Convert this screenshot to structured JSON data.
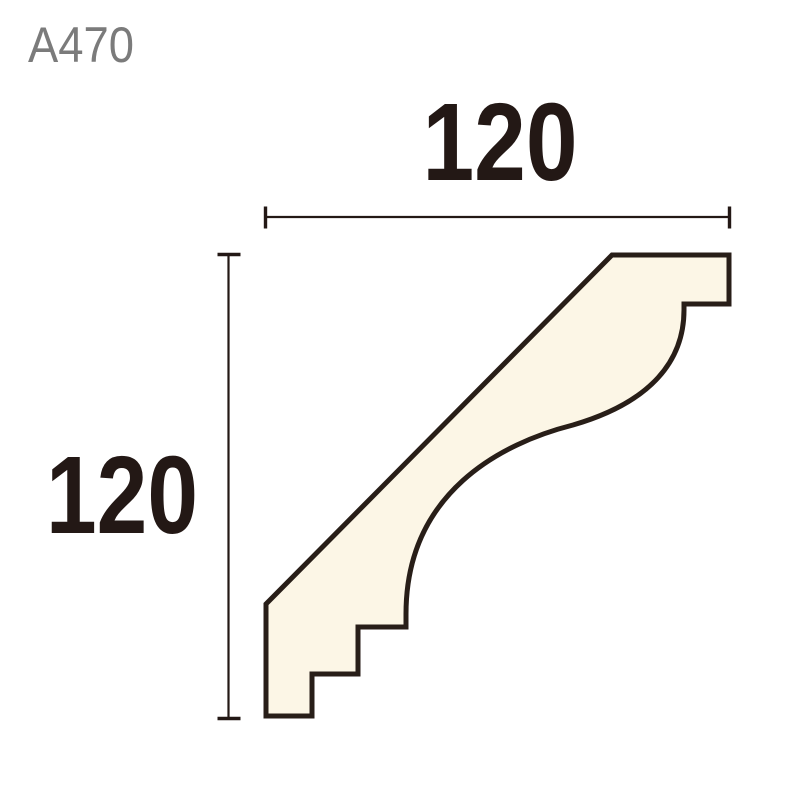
{
  "product_code": {
    "label": "A470"
  },
  "dimensions": {
    "width": {
      "value": "120"
    },
    "height": {
      "value": "120"
    }
  },
  "colors": {
    "background": "#ffffff",
    "profile_fill": "#FCF6E6",
    "profile_outline": "#281E18",
    "dimension_line": "#231815",
    "dimension_text": "#231815",
    "product_code_text": "#7B7B7B"
  }
}
